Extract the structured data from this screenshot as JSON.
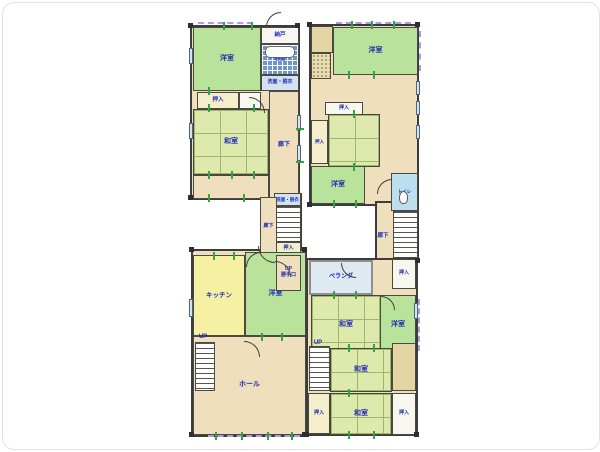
{
  "labels": {
    "western_room": "洋室",
    "japanese_room": "和室",
    "storage": "納戸",
    "bathroom": "浴室",
    "washroom": "洗面・脱衣",
    "closet": "押入",
    "corridor": "廊下",
    "kitchen": "キッチン",
    "hall": "ホール",
    "veranda": "ベランダ",
    "toilet": "トイレ",
    "up": "UP",
    "service_entrance": "UP\n勝手口"
  },
  "colors": {
    "wall": "#3c3c3c",
    "label_text": "#1d2ab5",
    "western_room": "#b9e39a",
    "tatami": "#dde9ad",
    "corridor": "#efdfbd",
    "kitchen": "#f6f0a3",
    "bath_tile": "#6e95cd",
    "tick_green": "#35a343",
    "window_dash": "#a79de2"
  },
  "elements": [
    {
      "name": "base-1f-top",
      "cls": "base",
      "x": 187,
      "y": 22,
      "w": 110,
      "h": 175
    },
    {
      "name": "base-1f-mid",
      "cls": "base",
      "x": 257,
      "y": 190,
      "w": 42,
      "h": 100
    },
    {
      "name": "base-1f-bottom",
      "cls": "base",
      "x": 188,
      "y": 246,
      "w": 116,
      "h": 188
    },
    {
      "name": "base-2f-top",
      "cls": "base",
      "x": 306,
      "y": 21,
      "w": 110,
      "h": 182
    },
    {
      "name": "base-2f-column",
      "cls": "base",
      "x": 372,
      "y": 198,
      "w": 44,
      "h": 62
    },
    {
      "name": "base-2f-bottom",
      "cls": "base",
      "x": 303,
      "y": 255,
      "w": 112,
      "h": 178
    },
    {
      "name": "room-1f-western-a",
      "cls": "green",
      "x": 190,
      "y": 24,
      "w": 68,
      "h": 64,
      "label": "洋室"
    },
    {
      "name": "room-1f-storage",
      "cls": "white",
      "x": 258,
      "y": 24,
      "w": 38,
      "h": 17,
      "label": "納戸",
      "fs": 5.5
    },
    {
      "name": "room-1f-bath",
      "cls": "bath",
      "x": 258,
      "y": 41,
      "w": 38,
      "h": 31,
      "label": "浴室",
      "fs": 5.5
    },
    {
      "name": "bathtub",
      "cls": "tub",
      "x": 262,
      "y": 43,
      "w": 30,
      "h": 12
    },
    {
      "name": "room-1f-washroom",
      "cls": "washroom",
      "x": 258,
      "y": 72,
      "w": 38,
      "h": 16,
      "label": "洗面・脱衣",
      "fs": 5
    },
    {
      "name": "room-1f-closet-a",
      "cls": "closet",
      "x": 194,
      "y": 89,
      "w": 42,
      "h": 17,
      "label": "押入",
      "fs": 5.5
    },
    {
      "name": "room-1f-closet-b",
      "cls": "white",
      "x": 236,
      "y": 89,
      "w": 22,
      "h": 17
    },
    {
      "name": "room-1f-japanese",
      "cls": "tatami",
      "x": 190,
      "y": 106,
      "w": 76,
      "h": 66,
      "label": "和室"
    },
    {
      "name": "room-1f-engawa",
      "cls": "beige",
      "x": 190,
      "y": 172,
      "w": 76,
      "h": 24
    },
    {
      "name": "room-1f-corridor",
      "cls": "beige",
      "x": 266,
      "y": 88,
      "w": 30,
      "h": 108,
      "label": "廊下",
      "fs": 6
    },
    {
      "name": "room-1f-washroom-mid",
      "cls": "washroom",
      "x": 271,
      "y": 190,
      "w": 27,
      "h": 13,
      "label": "洗面・脱衣",
      "fs": 4.5
    },
    {
      "name": "room-1f-corridor-mid",
      "cls": "beige",
      "x": 257,
      "y": 194,
      "w": 17,
      "h": 60,
      "label": "廊下",
      "fs": 5
    },
    {
      "name": "stairs-1f-mid",
      "cls": "stairs",
      "x": 273,
      "y": 203,
      "w": 25,
      "h": 36
    },
    {
      "name": "room-1f-closet-mid",
      "cls": "closet",
      "x": 273,
      "y": 239,
      "w": 25,
      "h": 13,
      "label": "押入",
      "fs": 5
    },
    {
      "name": "room-1f-western-b",
      "cls": "green",
      "x": 242,
      "y": 249,
      "w": 61,
      "h": 84,
      "label": "洋室"
    },
    {
      "name": "room-1f-service-entrance",
      "cls": "beige",
      "x": 273,
      "y": 252,
      "w": 25,
      "h": 36,
      "label": "UP\n勝手口",
      "fs": 5
    },
    {
      "name": "room-1f-kitchen",
      "cls": "yellow",
      "x": 190,
      "y": 252,
      "w": 52,
      "h": 81,
      "label": "キッチン",
      "fs": 6.5
    },
    {
      "name": "room-1f-hall",
      "cls": "beige",
      "x": 190,
      "y": 333,
      "w": 113,
      "h": 99,
      "label": "ホール"
    },
    {
      "name": "stairs-1f-hall",
      "cls": "stairs",
      "x": 192,
      "y": 339,
      "w": 20,
      "h": 49
    },
    {
      "name": "label-1f-up",
      "cls": "labelonly",
      "x": 191,
      "y": 330,
      "w": 18,
      "h": 8,
      "label": "UP",
      "fs": 6
    },
    {
      "name": "room-2f-closet-top",
      "cls": "tan",
      "x": 308,
      "y": 23,
      "w": 22,
      "h": 27
    },
    {
      "name": "room-2f-entry-stipple",
      "cls": "stipple",
      "x": 308,
      "y": 50,
      "w": 20,
      "h": 26
    },
    {
      "name": "room-2f-western-a",
      "cls": "green",
      "x": 330,
      "y": 24,
      "w": 85,
      "h": 48,
      "label": "洋室"
    },
    {
      "name": "room-2f-closet-a",
      "cls": "white",
      "x": 322,
      "y": 99,
      "w": 38,
      "h": 13,
      "label": "押入",
      "fs": 5
    },
    {
      "name": "room-2f-closet-b",
      "cls": "closet",
      "x": 308,
      "y": 117,
      "w": 17,
      "h": 44,
      "label": "押入",
      "fs": 4.5
    },
    {
      "name": "room-2f-japanese-a",
      "cls": "tatami",
      "x": 325,
      "y": 111,
      "w": 52,
      "h": 53
    },
    {
      "name": "room-2f-western-b",
      "cls": "green",
      "x": 308,
      "y": 163,
      "w": 54,
      "h": 38,
      "label": "洋室"
    },
    {
      "name": "room-2f-toilet",
      "cls": "toiletroom",
      "x": 388,
      "y": 170,
      "w": 27,
      "h": 38,
      "label": "トイレ",
      "fs": 4.5
    },
    {
      "name": "toilet-icon",
      "cls": "wc",
      "x": 396,
      "y": 188,
      "w": 9,
      "h": 13
    },
    {
      "name": "stairs-2f",
      "cls": "stairs",
      "x": 390,
      "y": 208,
      "w": 25,
      "h": 47
    },
    {
      "name": "label-2f-corridor",
      "cls": "labelonly",
      "x": 371,
      "y": 228,
      "w": 18,
      "h": 10,
      "label": "廊下",
      "fs": 5.5
    },
    {
      "name": "room-2f-closet-stairs",
      "cls": "white",
      "x": 389,
      "y": 256,
      "w": 24,
      "h": 30,
      "label": "押入",
      "fs": 5
    },
    {
      "name": "room-2f-veranda",
      "cls": "veranda",
      "x": 306,
      "y": 257,
      "w": 64,
      "h": 35,
      "label": "ベランダ",
      "fs": 6
    },
    {
      "name": "room-2f-japanese-b",
      "cls": "tatami",
      "x": 308,
      "y": 292,
      "w": 70,
      "h": 61,
      "label": "和室"
    },
    {
      "name": "room-2f-western-c",
      "cls": "green",
      "x": 377,
      "y": 292,
      "w": 36,
      "h": 61,
      "label": "洋室"
    },
    {
      "name": "stairs-2f-bottom",
      "cls": "stairs",
      "x": 306,
      "y": 343,
      "w": 21,
      "h": 45
    },
    {
      "name": "label-2f-up",
      "cls": "labelonly",
      "x": 306,
      "y": 336,
      "w": 18,
      "h": 8,
      "label": "UP",
      "fs": 6
    },
    {
      "name": "room-2f-japanese-c",
      "cls": "tatami",
      "x": 327,
      "y": 345,
      "w": 62,
      "h": 44,
      "label": "和室"
    },
    {
      "name": "room-2f-board-strip",
      "cls": "tan",
      "x": 389,
      "y": 340,
      "w": 24,
      "h": 48
    },
    {
      "name": "room-2f-closet-c",
      "cls": "closet",
      "x": 305,
      "y": 390,
      "w": 22,
      "h": 41,
      "label": "押入",
      "fs": 5
    },
    {
      "name": "room-2f-japanese-d",
      "cls": "tatami",
      "x": 327,
      "y": 390,
      "w": 62,
      "h": 42,
      "label": "和室"
    },
    {
      "name": "room-2f-closet-d",
      "cls": "white",
      "x": 389,
      "y": 390,
      "w": 24,
      "h": 42,
      "label": "押入",
      "fs": 5
    },
    {
      "name": "door-arc",
      "cls": "door-tl",
      "x": 263,
      "y": 9,
      "w": 15,
      "h": 15
    },
    {
      "name": "door-arc",
      "cls": "door-tr",
      "x": 246,
      "y": 94,
      "w": 16,
      "h": 16
    },
    {
      "name": "door-arc",
      "cls": "door-bl",
      "x": 255,
      "y": 243,
      "w": 17,
      "h": 17
    },
    {
      "name": "door-arc",
      "cls": "door-tr",
      "x": 272,
      "y": 258,
      "w": 16,
      "h": 16
    },
    {
      "name": "door-arc",
      "cls": "door-tl",
      "x": 243,
      "y": 249,
      "w": 15,
      "h": 15
    },
    {
      "name": "door-arc",
      "cls": "door-tr",
      "x": 241,
      "y": 338,
      "w": 16,
      "h": 16
    },
    {
      "name": "door-arc",
      "cls": "door-tl",
      "x": 374,
      "y": 176,
      "w": 15,
      "h": 15
    },
    {
      "name": "door-arc",
      "cls": "door-bl",
      "x": 338,
      "y": 260,
      "w": 15,
      "h": 15
    },
    {
      "name": "door-arc",
      "cls": "door-tr",
      "x": 378,
      "y": 293,
      "w": 14,
      "h": 14
    },
    {
      "name": "window",
      "cls": "win",
      "x": 294,
      "y": 112,
      "w": 4,
      "h": 16
    },
    {
      "name": "window",
      "cls": "win",
      "x": 294,
      "y": 142,
      "w": 4,
      "h": 16
    },
    {
      "name": "window",
      "cls": "win",
      "x": 186,
      "y": 45,
      "w": 4,
      "h": 16
    },
    {
      "name": "window",
      "cls": "win",
      "x": 186,
      "y": 120,
      "w": 4,
      "h": 16
    },
    {
      "name": "window",
      "cls": "win",
      "x": 186,
      "y": 296,
      "w": 4,
      "h": 18
    },
    {
      "name": "window",
      "cls": "win",
      "x": 413,
      "y": 78,
      "w": 4,
      "h": 14
    },
    {
      "name": "window",
      "cls": "win",
      "x": 413,
      "y": 98,
      "w": 4,
      "h": 14
    },
    {
      "name": "window",
      "cls": "win",
      "x": 413,
      "y": 122,
      "w": 4,
      "h": 14
    },
    {
      "name": "window",
      "cls": "win",
      "x": 411,
      "y": 300,
      "w": 4,
      "h": 16
    },
    {
      "name": "window-dash",
      "cls": "dashh",
      "x": 195,
      "y": 19,
      "w": 55,
      "h": 2
    },
    {
      "name": "window-dash",
      "cls": "dashh",
      "x": 333,
      "y": 19,
      "w": 75,
      "h": 2
    },
    {
      "name": "window-dash",
      "cls": "dashv",
      "x": 416,
      "y": 28,
      "w": 2,
      "h": 40
    },
    {
      "name": "window-dash",
      "cls": "dashv",
      "x": 415,
      "y": 296,
      "w": 2,
      "h": 52
    },
    {
      "name": "window-dash",
      "cls": "dashh",
      "x": 205,
      "y": 432,
      "w": 92,
      "h": 2
    },
    {
      "name": "opening-tick",
      "cls": "tickv",
      "x": 220,
      "y": 19,
      "w": 2,
      "h": 8
    },
    {
      "name": "opening-tick",
      "cls": "tickv",
      "x": 248,
      "y": 19,
      "w": 2,
      "h": 8
    },
    {
      "name": "opening-tick",
      "cls": "tickv",
      "x": 205,
      "y": 84,
      "w": 2,
      "h": 8
    },
    {
      "name": "opening-tick",
      "cls": "tickv",
      "x": 205,
      "y": 101,
      "w": 2,
      "h": 8
    },
    {
      "name": "opening-tick",
      "cls": "tickv",
      "x": 250,
      "y": 101,
      "w": 2,
      "h": 8
    },
    {
      "name": "opening-tick",
      "cls": "tickv",
      "x": 205,
      "y": 168,
      "w": 2,
      "h": 8
    },
    {
      "name": "opening-tick",
      "cls": "tickv",
      "x": 228,
      "y": 168,
      "w": 2,
      "h": 8
    },
    {
      "name": "opening-tick",
      "cls": "tickv",
      "x": 250,
      "y": 168,
      "w": 2,
      "h": 8
    },
    {
      "name": "opening-tick",
      "cls": "tickv",
      "x": 205,
      "y": 191,
      "w": 2,
      "h": 8
    },
    {
      "name": "opening-tick",
      "cls": "tickv",
      "x": 240,
      "y": 191,
      "w": 2,
      "h": 8
    },
    {
      "name": "opening-tick",
      "cls": "tickh",
      "x": 293,
      "y": 125,
      "w": 8,
      "h": 2
    },
    {
      "name": "opening-tick",
      "cls": "tickh",
      "x": 293,
      "y": 158,
      "w": 8,
      "h": 2
    },
    {
      "name": "opening-tick",
      "cls": "tickv",
      "x": 210,
      "y": 249,
      "w": 2,
      "h": 8
    },
    {
      "name": "opening-tick",
      "cls": "tickv",
      "x": 230,
      "y": 249,
      "w": 2,
      "h": 8
    },
    {
      "name": "opening-tick",
      "cls": "tickv",
      "x": 258,
      "y": 330,
      "w": 2,
      "h": 8
    },
    {
      "name": "opening-tick",
      "cls": "tickv",
      "x": 278,
      "y": 330,
      "w": 2,
      "h": 8
    },
    {
      "name": "opening-tick",
      "cls": "tickv",
      "x": 212,
      "y": 429,
      "w": 2,
      "h": 8
    },
    {
      "name": "opening-tick",
      "cls": "tickv",
      "x": 238,
      "y": 429,
      "w": 2,
      "h": 8
    },
    {
      "name": "opening-tick",
      "cls": "tickv",
      "x": 264,
      "y": 429,
      "w": 2,
      "h": 8
    },
    {
      "name": "opening-tick",
      "cls": "tickv",
      "x": 288,
      "y": 429,
      "w": 2,
      "h": 8
    },
    {
      "name": "opening-tick",
      "cls": "tickv",
      "x": 348,
      "y": 18,
      "w": 2,
      "h": 8
    },
    {
      "name": "opening-tick",
      "cls": "tickv",
      "x": 368,
      "y": 18,
      "w": 2,
      "h": 8
    },
    {
      "name": "opening-tick",
      "cls": "tickv",
      "x": 390,
      "y": 18,
      "w": 2,
      "h": 8
    },
    {
      "name": "opening-tick",
      "cls": "tickv",
      "x": 345,
      "y": 68,
      "w": 2,
      "h": 8
    },
    {
      "name": "opening-tick",
      "cls": "tickv",
      "x": 370,
      "y": 68,
      "w": 2,
      "h": 8
    },
    {
      "name": "opening-tick",
      "cls": "tickv",
      "x": 350,
      "y": 107,
      "w": 2,
      "h": 8
    },
    {
      "name": "opening-tick",
      "cls": "tickv",
      "x": 350,
      "y": 160,
      "w": 2,
      "h": 8
    },
    {
      "name": "opening-tick",
      "cls": "tickv",
      "x": 330,
      "y": 197,
      "w": 2,
      "h": 8
    },
    {
      "name": "opening-tick",
      "cls": "tickv",
      "x": 352,
      "y": 197,
      "w": 2,
      "h": 8
    },
    {
      "name": "opening-tick",
      "cls": "tickv",
      "x": 330,
      "y": 288,
      "w": 2,
      "h": 8
    },
    {
      "name": "opening-tick",
      "cls": "tickv",
      "x": 352,
      "y": 288,
      "w": 2,
      "h": 8
    },
    {
      "name": "opening-tick",
      "cls": "tickv",
      "x": 345,
      "y": 341,
      "w": 2,
      "h": 8
    },
    {
      "name": "opening-tick",
      "cls": "tickv",
      "x": 370,
      "y": 341,
      "w": 2,
      "h": 8
    },
    {
      "name": "opening-tick",
      "cls": "tickv",
      "x": 345,
      "y": 386,
      "w": 2,
      "h": 8
    },
    {
      "name": "opening-tick",
      "cls": "tickv",
      "x": 345,
      "y": 428,
      "w": 2,
      "h": 8
    },
    {
      "name": "opening-tick",
      "cls": "tickv",
      "x": 370,
      "y": 428,
      "w": 2,
      "h": 8
    },
    {
      "name": "wall-post",
      "cls": "post",
      "x": 185,
      "y": 20,
      "w": 5,
      "h": 5
    },
    {
      "name": "wall-post",
      "cls": "post",
      "x": 292,
      "y": 20,
      "w": 5,
      "h": 5
    },
    {
      "name": "wall-post",
      "cls": "post",
      "x": 185,
      "y": 192,
      "w": 5,
      "h": 5
    },
    {
      "name": "wall-post",
      "cls": "post",
      "x": 186,
      "y": 244,
      "w": 5,
      "h": 5
    },
    {
      "name": "wall-post",
      "cls": "post",
      "x": 299,
      "y": 244,
      "w": 5,
      "h": 5
    },
    {
      "name": "wall-post",
      "cls": "post",
      "x": 186,
      "y": 429,
      "w": 5,
      "h": 5
    },
    {
      "name": "wall-post",
      "cls": "post",
      "x": 299,
      "y": 429,
      "w": 5,
      "h": 5
    },
    {
      "name": "wall-post",
      "cls": "post",
      "x": 304,
      "y": 19,
      "w": 5,
      "h": 5
    },
    {
      "name": "wall-post",
      "cls": "post",
      "x": 412,
      "y": 19,
      "w": 5,
      "h": 5
    },
    {
      "name": "wall-post",
      "cls": "post",
      "x": 304,
      "y": 199,
      "w": 5,
      "h": 5
    },
    {
      "name": "wall-post",
      "cls": "post",
      "x": 412,
      "y": 255,
      "w": 5,
      "h": 5
    },
    {
      "name": "wall-post",
      "cls": "post",
      "x": 301,
      "y": 429,
      "w": 5,
      "h": 5
    },
    {
      "name": "wall-post",
      "cls": "post",
      "x": 411,
      "y": 429,
      "w": 5,
      "h": 5
    }
  ]
}
